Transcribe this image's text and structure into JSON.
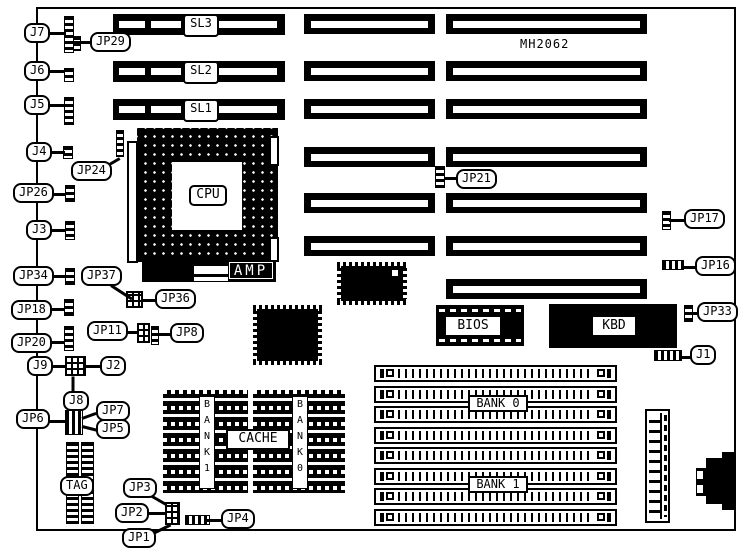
{
  "part_number": "MH2062",
  "cpu": {
    "label": "CPU",
    "maker": "AMP"
  },
  "chips": {
    "bios": "BIOS",
    "kbd": "KBD",
    "cache": "CACHE"
  },
  "slots": {
    "left": {
      "x": 113,
      "w": 172,
      "h": 21,
      "rows": [
        {
          "label": "SL3",
          "y": 14
        },
        {
          "label": "SL2",
          "y": 61
        },
        {
          "label": "SL1",
          "y": 99
        }
      ]
    },
    "mid": {
      "x": 304,
      "w": 131,
      "h": 20,
      "ys": [
        14,
        61,
        99,
        147,
        193,
        236
      ]
    },
    "right": {
      "x": 446,
      "w": 201,
      "h": 20,
      "ys": [
        14,
        61,
        99,
        147,
        193,
        236,
        279
      ]
    }
  },
  "memory": {
    "rows": {
      "x": 374,
      "w": 243,
      "h": 17,
      "ys": [
        365,
        386,
        406,
        427,
        447,
        468,
        488,
        509
      ]
    },
    "banks": [
      {
        "label": "BANK 0",
        "x": 468,
        "y": 395
      },
      {
        "label": "BANK 1",
        "x": 468,
        "y": 476
      }
    ]
  },
  "cache": {
    "blocks": [
      {
        "label": "BANK1",
        "x": 163,
        "y": 390,
        "w": 85,
        "h": 103
      },
      {
        "label": "BANK0",
        "x": 253,
        "y": 390,
        "w": 92,
        "h": 103
      }
    ],
    "label_box": {
      "x": 226,
      "y": 429,
      "w": 64,
      "h": 21
    }
  },
  "callouts": [
    {
      "id": "j7",
      "label": "J7",
      "x": 24,
      "y": 23,
      "leader": [
        49,
        32,
        17,
        0
      ]
    },
    {
      "id": "jp29",
      "label": "JP29",
      "x": 90,
      "y": 32,
      "leader": [
        74,
        41,
        18,
        0
      ]
    },
    {
      "id": "j6",
      "label": "J6",
      "x": 24,
      "y": 61,
      "leader": [
        46,
        70,
        19,
        0
      ]
    },
    {
      "id": "j5",
      "label": "J5",
      "x": 24,
      "y": 95,
      "leader": [
        46,
        104,
        19,
        0
      ]
    },
    {
      "id": "j4",
      "label": "J4",
      "x": 26,
      "y": 142,
      "leader": [
        48,
        151,
        17,
        0
      ]
    },
    {
      "id": "jp24",
      "label": "JP24",
      "x": 71,
      "y": 161,
      "leader": [
        99,
        169,
        24,
        -30
      ]
    },
    {
      "id": "jp26",
      "label": "JP26",
      "x": 13,
      "y": 183,
      "leader": [
        49,
        193,
        17,
        0
      ]
    },
    {
      "id": "j3",
      "label": "J3",
      "x": 26,
      "y": 220,
      "leader": [
        48,
        229,
        18,
        0
      ]
    },
    {
      "id": "jp34",
      "label": "JP34",
      "x": 13,
      "y": 266,
      "leader": [
        48,
        275,
        18,
        0
      ]
    },
    {
      "id": "jp37",
      "label": "JP37",
      "x": 81,
      "y": 266,
      "leader": [
        111,
        284,
        25,
        33
      ]
    },
    {
      "id": "jp36",
      "label": "JP36",
      "x": 155,
      "y": 289,
      "leader": [
        141,
        299,
        16,
        0
      ]
    },
    {
      "id": "jp18",
      "label": "JP18",
      "x": 11,
      "y": 300,
      "leader": [
        46,
        308,
        19,
        0
      ]
    },
    {
      "id": "jp11",
      "label": "JP11",
      "x": 87,
      "y": 321,
      "leader": [
        122,
        331,
        17,
        0
      ]
    },
    {
      "id": "jp8",
      "label": "JP8",
      "x": 170,
      "y": 323,
      "leader": [
        157,
        333,
        14,
        0
      ]
    },
    {
      "id": "jp20",
      "label": "JP20",
      "x": 11,
      "y": 333,
      "leader": [
        46,
        341,
        19,
        0
      ]
    },
    {
      "id": "j9",
      "label": "J9",
      "x": 27,
      "y": 356,
      "leader": [
        50,
        365,
        16,
        0
      ]
    },
    {
      "id": "j2",
      "label": "J2",
      "x": 100,
      "y": 356,
      "leader": [
        84,
        365,
        17,
        0
      ]
    },
    {
      "id": "j8",
      "label": "J8",
      "x": 63,
      "y": 391,
      "leader": [
        73,
        375,
        17,
        90
      ]
    },
    {
      "id": "jp6",
      "label": "JP6",
      "x": 16,
      "y": 409,
      "leader": [
        47,
        420,
        19,
        0
      ]
    },
    {
      "id": "jp7",
      "label": "JP7",
      "x": 96,
      "y": 401,
      "leader": [
        82,
        417,
        15,
        -20
      ]
    },
    {
      "id": "jp5",
      "label": "JP5",
      "x": 96,
      "y": 419,
      "leader": [
        82,
        425,
        15,
        14
      ]
    },
    {
      "id": "tag",
      "label": "TAG",
      "x": 60,
      "y": 476,
      "leader": null
    },
    {
      "id": "jp3",
      "label": "JP3",
      "x": 123,
      "y": 478,
      "leader": [
        147,
        492,
        22,
        30
      ]
    },
    {
      "id": "jp2",
      "label": "JP2",
      "x": 115,
      "y": 503,
      "leader": [
        144,
        512,
        22,
        0
      ]
    },
    {
      "id": "jp1",
      "label": "JP1",
      "x": 122,
      "y": 528,
      "leader": [
        149,
        534,
        24,
        -26
      ]
    },
    {
      "id": "jp4",
      "label": "JP4",
      "x": 221,
      "y": 509,
      "leader": [
        207,
        519,
        16,
        0
      ]
    },
    {
      "id": "jp21",
      "label": "JP21",
      "x": 456,
      "y": 169,
      "leader": [
        444,
        177,
        13,
        0
      ]
    },
    {
      "id": "jp17",
      "label": "JP17",
      "x": 684,
      "y": 209,
      "leader": [
        669,
        219,
        16,
        0
      ]
    },
    {
      "id": "jp16",
      "label": "JP16",
      "x": 695,
      "y": 256,
      "leader": [
        682,
        266,
        14,
        0
      ]
    },
    {
      "id": "jp33",
      "label": "JP33",
      "x": 697,
      "y": 302,
      "leader": [
        691,
        312,
        8,
        0
      ]
    },
    {
      "id": "j1",
      "label": "J1",
      "x": 690,
      "y": 345,
      "leader": [
        680,
        356,
        11,
        0
      ]
    }
  ],
  "jumpers": [
    {
      "id": "jp29-a",
      "type": "v",
      "x": 64,
      "y": 16,
      "w": 10,
      "h": 37
    },
    {
      "id": "jp29-b",
      "type": "v",
      "x": 73,
      "y": 36,
      "w": 8,
      "h": 15
    },
    {
      "id": "j6",
      "type": "v",
      "x": 64,
      "y": 68,
      "w": 10,
      "h": 14
    },
    {
      "id": "j5",
      "type": "v",
      "x": 64,
      "y": 97,
      "w": 10,
      "h": 28
    },
    {
      "id": "j4",
      "type": "v",
      "x": 63,
      "y": 146,
      "w": 10,
      "h": 13
    },
    {
      "id": "jp24",
      "type": "v",
      "x": 116,
      "y": 130,
      "w": 8,
      "h": 27
    },
    {
      "id": "jp26",
      "type": "v",
      "x": 65,
      "y": 185,
      "w": 10,
      "h": 17
    },
    {
      "id": "j3",
      "type": "v",
      "x": 65,
      "y": 221,
      "w": 10,
      "h": 19
    },
    {
      "id": "jp34",
      "type": "v",
      "x": 65,
      "y": 268,
      "w": 10,
      "h": 17
    },
    {
      "id": "jp36",
      "type": "g",
      "x": 126,
      "y": 291,
      "w": 17,
      "h": 17
    },
    {
      "id": "jp18",
      "type": "v",
      "x": 64,
      "y": 299,
      "w": 10,
      "h": 17
    },
    {
      "id": "jp20",
      "type": "v",
      "x": 64,
      "y": 326,
      "w": 10,
      "h": 25
    },
    {
      "id": "jp11",
      "type": "g",
      "x": 137,
      "y": 323,
      "w": 13,
      "h": 20
    },
    {
      "id": "jp8",
      "type": "v",
      "x": 151,
      "y": 326,
      "w": 8,
      "h": 19
    },
    {
      "id": "j9",
      "type": "g",
      "x": 65,
      "y": 356,
      "w": 21,
      "h": 20
    },
    {
      "id": "jp6",
      "type": "h",
      "x": 65,
      "y": 410,
      "w": 18,
      "h": 25
    },
    {
      "id": "jp1-jp2-jp3",
      "type": "g",
      "x": 165,
      "y": 502,
      "w": 15,
      "h": 23
    },
    {
      "id": "jp4",
      "type": "h",
      "x": 185,
      "y": 515,
      "w": 25,
      "h": 10
    },
    {
      "id": "jp21",
      "type": "v",
      "x": 435,
      "y": 166,
      "w": 10,
      "h": 22
    },
    {
      "id": "jp17",
      "type": "v",
      "x": 662,
      "y": 211,
      "w": 9,
      "h": 19
    },
    {
      "id": "jp16",
      "type": "h",
      "x": 662,
      "y": 260,
      "w": 22,
      "h": 10
    },
    {
      "id": "jp33",
      "type": "v",
      "x": 684,
      "y": 305,
      "w": 9,
      "h": 17
    },
    {
      "id": "j1",
      "type": "h",
      "x": 654,
      "y": 350,
      "w": 28,
      "h": 11
    },
    {
      "id": "tag-chip-left",
      "type": "v",
      "x": 66,
      "y": 442,
      "w": 13,
      "h": 82
    },
    {
      "id": "tag-chip-right",
      "type": "v",
      "x": 81,
      "y": 442,
      "w": 13,
      "h": 82
    }
  ]
}
